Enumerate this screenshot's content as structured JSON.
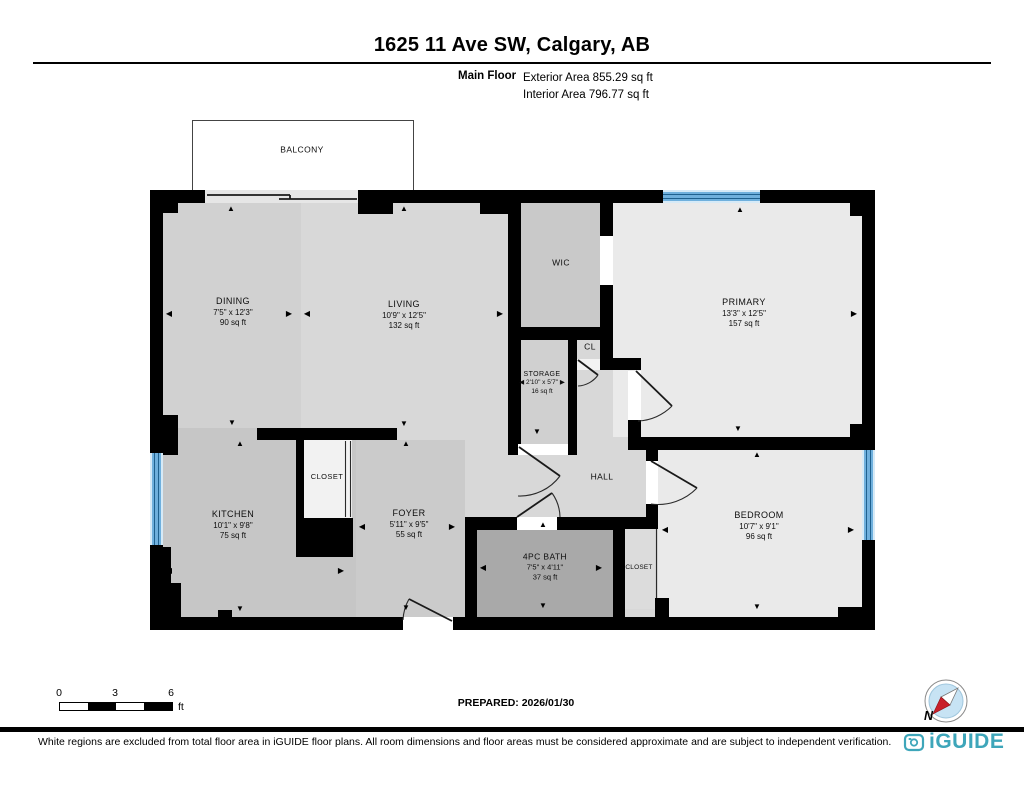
{
  "header": {
    "title": "1625 11 Ave SW, Calgary, AB",
    "floor_label": "Main Floor",
    "exterior_area": "Exterior Area 855.29 sq ft",
    "interior_area": "Interior Area 796.77 sq ft"
  },
  "plan": {
    "balcony_label": "BALCONY",
    "rooms": {
      "dining": {
        "name": "DINING",
        "dims": "7'5\" x 12'3\"",
        "area": "90 sq ft"
      },
      "living": {
        "name": "LIVING",
        "dims": "10'9\" x 12'5\"",
        "area": "132 sq ft"
      },
      "wic": {
        "name": "WIC"
      },
      "primary": {
        "name": "PRIMARY",
        "dims": "13'3\" x 12'5\"",
        "area": "157 sq ft"
      },
      "storage": {
        "name": "STORAGE",
        "dims": "2'10\" x 5'7\"",
        "area": "16 sq ft"
      },
      "cl": {
        "name": "CL"
      },
      "hall": {
        "name": "HALL"
      },
      "closet_entry": {
        "name": "CLOSET"
      },
      "kitchen": {
        "name": "KITCHEN",
        "dims": "10'1\" x 9'8\"",
        "area": "75 sq ft"
      },
      "foyer": {
        "name": "FOYER",
        "dims": "5'11\" x 9'5\"",
        "area": "55 sq ft"
      },
      "bath": {
        "name": "4PC BATH",
        "dims": "7'5\" x 4'11\"",
        "area": "37 sq ft"
      },
      "closet_bedroom": {
        "name": "CLOSET"
      },
      "bedroom": {
        "name": "BEDROOM",
        "dims": "10'7\" x 9'1\"",
        "area": "96 sq ft"
      }
    }
  },
  "scale_bar": {
    "t0": "0",
    "t3": "3",
    "t6": "6",
    "unit": "ft"
  },
  "prepared_label": "PREPARED: 2026/01/30",
  "compass": {
    "north": "N"
  },
  "footer": {
    "disclaimer": "White regions are excluded from total floor area in iGUIDE floor plans. All room dimensions and floor areas must be considered approximate and are subject to independent verification.",
    "brand": "iGUIDE"
  },
  "icons": {
    "up": "▲",
    "down": "▼",
    "left": "◀",
    "right": "▶"
  },
  "colors": {
    "wall_black": "#000000",
    "window_blue": "#6fb0dd",
    "logo_teal": "#3ea6ba",
    "compass_red": "#c9202b",
    "bath_gray": "#a9a9a9"
  }
}
